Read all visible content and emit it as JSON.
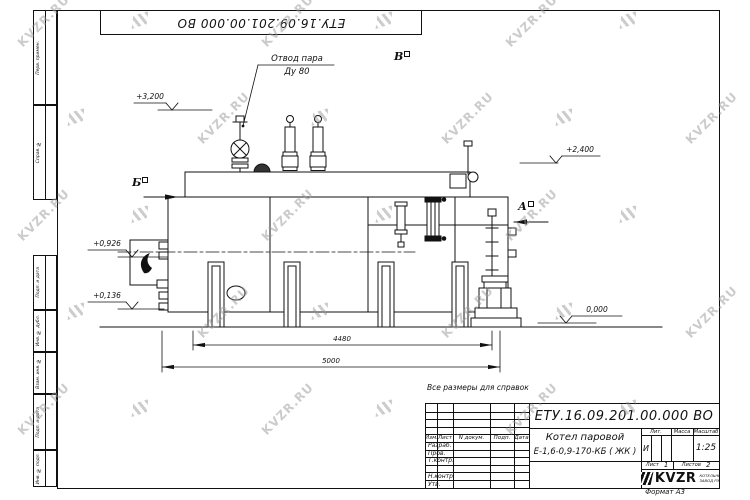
{
  "watermark": {
    "text": "KVZR.RU"
  },
  "doc": {
    "top_number": "ЕТУ.16.09.201.00.000  ВО",
    "note": "Все размеры для справок",
    "format_label": "Формат А3"
  },
  "frame": {
    "left_boxes": [
      "Перв. примен.",
      "Справ. №",
      "Подп. и дата",
      "Инв. № дубл.",
      "Взам. инв. №",
      "Подп. и дата",
      "Инв. № подл."
    ]
  },
  "drawing": {
    "steam_callout_line1": "Отвод пара",
    "steam_callout_line2": "Ду 80",
    "marker_b": "Б",
    "marker_v": "В",
    "marker_a": "А",
    "elevations": [
      "+3,200",
      "+2,400",
      "+0,926",
      "+0,136",
      "0,000"
    ],
    "dim_4480": "4480",
    "dim_5000": "5000"
  },
  "title_block": {
    "doc_number": "ЕТУ.16.09.201.00.000  ВО",
    "product_line1": "Котел паровой",
    "product_line2": "Е-1,6-0,9-170-КБ ( ЖК )",
    "col_izm": "Изм.",
    "col_list": "Лист",
    "col_dokum": "N докум.",
    "col_podp": "Подп.",
    "col_data": "Дата",
    "rows": [
      "Разраб.",
      "Пров.",
      "Т.контр.",
      "",
      "Н.контр.",
      "Утв."
    ],
    "lit_header": "Лит.",
    "mass_header": "Масса",
    "scale_header": "Масштаб",
    "lit_value": "И",
    "scale_value": "1:25",
    "sheet_label": "Лист",
    "sheet_value": "1",
    "sheets_label": "Листов",
    "sheets_value": "2",
    "logo_text": "KVZR",
    "logo_sub_line1": "КОТЕЛЬНЫЙ",
    "logo_sub_line2": "ЗАВОД РЭП"
  }
}
